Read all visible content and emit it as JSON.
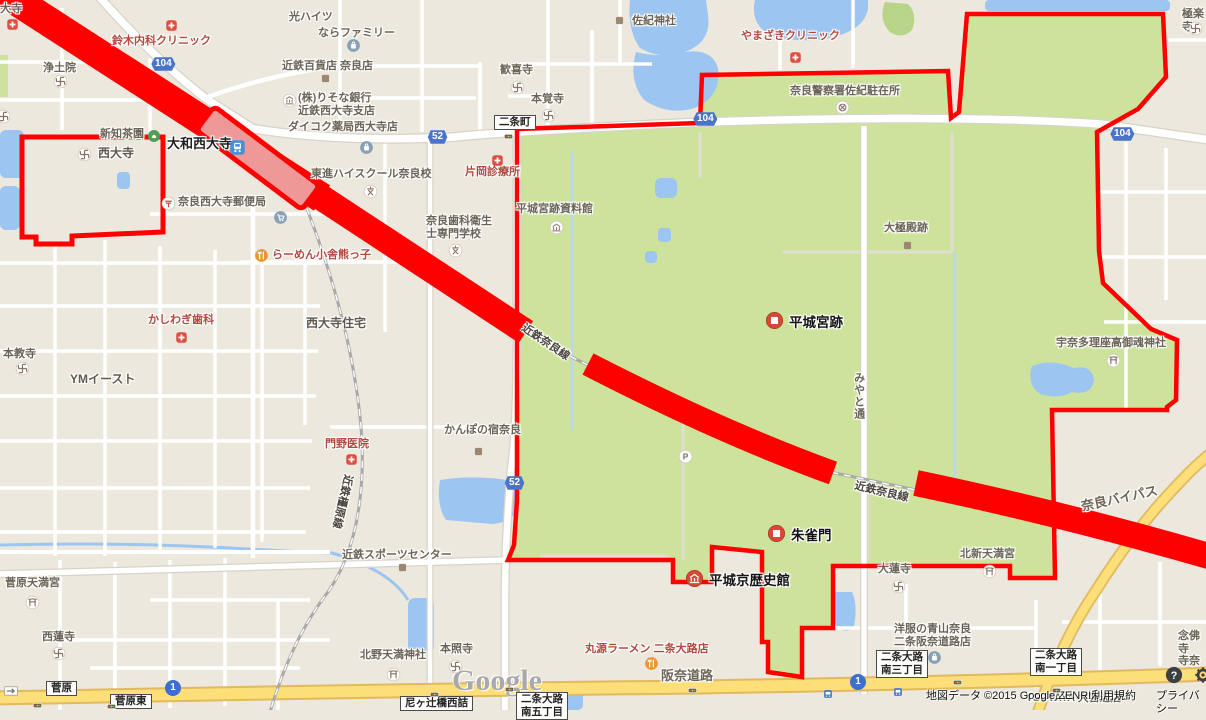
{
  "map": {
    "colors": {
      "background": "#ece8dd",
      "park_green": "#cde39c",
      "water": "#9dc5f2",
      "highlight_red": "#ff0000",
      "station_fill": "#ef9898",
      "yellow_road": "#fcdf79",
      "shield_blue": "#4b74c9"
    },
    "labels": [
      {
        "n": "poi-daiji-partial",
        "t": "大寺",
        "x": 0,
        "y": 3,
        "c": "poi"
      },
      {
        "n": "poi-jodoin",
        "t": "浄土院",
        "x": 43,
        "y": 62,
        "c": "poi"
      },
      {
        "n": "poi-hikari-heights",
        "t": "光ハイツ",
        "x": 289,
        "y": 11,
        "c": "poi"
      },
      {
        "n": "poi-nara-family",
        "t": "ならファミリー",
        "x": 318,
        "y": 27,
        "c": "poi"
      },
      {
        "n": "poi-kintetsu-dept",
        "t": "近鉄百貨店 奈良店",
        "x": 282,
        "y": 60,
        "c": "poi"
      },
      {
        "n": "poi-kankiji",
        "t": "歓喜寺",
        "x": 500,
        "y": 64,
        "c": "poi"
      },
      {
        "n": "poi-hongakuji",
        "t": "本覚寺",
        "x": 531,
        "y": 93,
        "c": "poi"
      },
      {
        "n": "poi-saki-jinja",
        "t": "佐紀神社",
        "x": 632,
        "y": 15,
        "c": "poi"
      },
      {
        "n": "poi-risona-bank",
        "t": "(株)りそな銀行\n近鉄西大寺支店",
        "x": 298,
        "y": 92,
        "c": "poi"
      },
      {
        "n": "poi-daikoku-pharmacy",
        "t": "ダイコク薬局西大寺店",
        "x": 288,
        "y": 121,
        "c": "poi"
      },
      {
        "n": "poi-nara-police-saki",
        "t": "奈良警察署佐紀駐在所",
        "x": 790,
        "y": 85,
        "c": "poi"
      },
      {
        "n": "poi-shinchi-chaen",
        "t": "新知茶園",
        "x": 100,
        "y": 128,
        "c": "poi"
      },
      {
        "n": "poi-saidaiji-temple",
        "t": "西大寺",
        "x": 98,
        "y": 147,
        "c": "poi2"
      },
      {
        "n": "poi-toshin-highschool",
        "t": "東進ハイスクール奈良校",
        "x": 311,
        "y": 168,
        "c": "poi"
      },
      {
        "n": "poi-saidaiji-post-office",
        "t": "奈良西大寺郵便局",
        "x": 178,
        "y": 196,
        "c": "poi"
      },
      {
        "n": "poi-heijo-shiryokan",
        "t": "平城宮跡資料館",
        "x": 516,
        "y": 203,
        "c": "poi"
      },
      {
        "n": "poi-nara-dental-school",
        "t": "奈良歯科衛生\n士専門学校",
        "x": 426,
        "y": 215,
        "c": "poi"
      },
      {
        "n": "poi-daigokuden-ruins",
        "t": "大極殿跡",
        "x": 884,
        "y": 222,
        "c": "poi"
      },
      {
        "n": "poi-gokurakuji",
        "t": "極楽寺",
        "x": 1182,
        "y": 8,
        "c": "poi"
      },
      {
        "n": "poi-saidaiji-jutaku",
        "t": "西大寺住宅",
        "x": 306,
        "y": 317,
        "c": "poi2"
      },
      {
        "n": "poi-honkyoji",
        "t": "本教寺",
        "x": 3,
        "y": 348,
        "c": "poi"
      },
      {
        "n": "poi-ym-east",
        "t": "YMイースト",
        "x": 70,
        "y": 373,
        "c": "poi2"
      },
      {
        "n": "poi-kanpo-no-yado",
        "t": "かんぽの宿奈良",
        "x": 444,
        "y": 424,
        "c": "poi"
      },
      {
        "n": "poi-unatari-jinja",
        "t": "宇奈多理座高御魂神社",
        "x": 1056,
        "y": 337,
        "c": "poi"
      },
      {
        "n": "poi-kintetsu-sports",
        "t": "近鉄スポーツセンター",
        "x": 342,
        "y": 549,
        "c": "poi"
      },
      {
        "n": "poi-dairenji",
        "t": "大蓮寺",
        "x": 878,
        "y": 563,
        "c": "poi"
      },
      {
        "n": "poi-kitashin-tenmangu",
        "t": "北新天満宮",
        "x": 960,
        "y": 548,
        "c": "poi"
      },
      {
        "n": "poi-sugahara-tenmangu",
        "t": "菅原天満宮",
        "x": 5,
        "y": 577,
        "c": "poi"
      },
      {
        "n": "poi-sairenji",
        "t": "西蓮寺",
        "x": 42,
        "y": 631,
        "c": "poi"
      },
      {
        "n": "poi-honshoji",
        "t": "本照寺",
        "x": 440,
        "y": 643,
        "c": "poi"
      },
      {
        "n": "poi-kitano-tenmanjinja",
        "t": "北野天満神社",
        "x": 360,
        "y": 649,
        "c": "poi"
      },
      {
        "n": "poi-aoyama",
        "t": "洋服の青山奈良\n二条阪奈道路店",
        "x": 894,
        "y": 623,
        "c": "poi"
      },
      {
        "n": "poi-tsutaya",
        "t": "TSUTAYA 大宮通店",
        "x": 1026,
        "y": 692,
        "c": "poi"
      },
      {
        "n": "poi-nenbutsuji",
        "t": "念佛寺\n寺奈",
        "x": 1178,
        "y": 630,
        "c": "poi"
      },
      {
        "n": "poi-suzuki-clinic",
        "t": "鈴木内科クリニック",
        "x": 112,
        "y": 35,
        "c": "red"
      },
      {
        "n": "poi-yamazaki-clinic",
        "t": "やまざきクリニック",
        "x": 741,
        "y": 30,
        "c": "red"
      },
      {
        "n": "poi-kataoka-clinic",
        "t": "片岡診療所",
        "x": 465,
        "y": 166,
        "c": "red"
      },
      {
        "n": "poi-ramen-kumakko",
        "t": "らーめん小舎熊っ子",
        "x": 272,
        "y": 249,
        "c": "red"
      },
      {
        "n": "poi-kashiwagi-dental",
        "t": "かしわぎ歯科",
        "x": 148,
        "y": 314,
        "c": "red"
      },
      {
        "n": "poi-kadono-clinic",
        "t": "門野医院",
        "x": 325,
        "y": 438,
        "c": "red"
      },
      {
        "n": "poi-marugen-ramen",
        "t": "丸源ラーメン 二条大路店",
        "x": 585,
        "y": 643,
        "c": "red"
      },
      {
        "n": "station-yamato-saidaiji",
        "t": "大和西大寺",
        "x": 167,
        "y": 137,
        "c": "big"
      },
      {
        "n": "road-hanna-doro",
        "t": "阪奈道路",
        "x": 661,
        "y": 669,
        "c": "road"
      },
      {
        "n": "road-nara-bypass",
        "t": "奈良バイパス",
        "x": 1080,
        "y": 500,
        "c": "road",
        "r": -12
      },
      {
        "n": "rail-kintetsu-nara-line-w",
        "t": "近鉄奈良線",
        "x": 526,
        "y": 322,
        "c": "rail",
        "r": 34
      },
      {
        "n": "rail-kintetsu-nara-line-e",
        "t": "近鉄奈良線",
        "x": 856,
        "y": 480,
        "c": "rail",
        "r": 13
      },
      {
        "n": "rail-kintetsu-kashihara-line",
        "t": "近鉄橿原線",
        "x": 354,
        "y": 476,
        "c": "rail",
        "r": 103
      },
      {
        "n": "road-miyato-dori",
        "t": "みやと通",
        "x": 852,
        "y": 372,
        "c": "vert"
      },
      {
        "n": "attribution-copyright",
        "t": "地図データ ©2015 Google,ZENRIN",
        "x": 926,
        "y": 690,
        "c": "attr"
      },
      {
        "n": "link-terms",
        "t": "利用規約",
        "x": 1092,
        "y": 690,
        "c": "attr",
        "i": true
      },
      {
        "n": "link-privacy",
        "t": "プライバシー",
        "x": 1156,
        "y": 690,
        "c": "attr",
        "i": true
      },
      {
        "n": "google-logo",
        "t": "Google",
        "x": 452,
        "y": 664,
        "c": "google",
        "i": true
      }
    ],
    "shields": [
      {
        "n": "shield-route-104-nw",
        "t": "104",
        "x": 149,
        "y": 57
      },
      {
        "n": "shield-route-104-mid",
        "t": "104",
        "x": 691,
        "y": 112
      },
      {
        "n": "shield-route-104-e",
        "t": "104",
        "x": 1108,
        "y": 127
      },
      {
        "n": "shield-route-52-w",
        "t": "52",
        "x": 426,
        "y": 130
      },
      {
        "n": "shield-route-52-s",
        "t": "52",
        "x": 503,
        "y": 476
      },
      {
        "n": "shield-route-1-w",
        "t": "1",
        "x": 165,
        "y": 680,
        "circle": true
      },
      {
        "n": "shield-route-1-e",
        "t": "1",
        "x": 850,
        "y": 674,
        "circle": true
      }
    ],
    "boxes": [
      {
        "n": "box-nijo-cho",
        "t": "二条町",
        "x": 494,
        "y": 115
      },
      {
        "n": "box-sugahara",
        "t": "菅原",
        "x": 46,
        "y": 681
      },
      {
        "n": "box-sugahara-higashi",
        "t": "菅原東",
        "x": 110,
        "y": 694
      },
      {
        "n": "box-amagatsuji-bashi",
        "t": "尼ヶ辻橋西詰",
        "x": 400,
        "y": 696
      },
      {
        "n": "box-nijooji-minami-5",
        "t": "二条大路\n南五丁目",
        "x": 516,
        "y": 692
      },
      {
        "n": "box-nijooji-minami-3",
        "t": "二条大路\n南三丁目",
        "x": 876,
        "y": 650
      },
      {
        "n": "box-nijooji-minami-1",
        "t": "二条大路\n南一丁目",
        "x": 1030,
        "y": 648
      }
    ],
    "markers": [
      {
        "n": "marker-heijo-palace-site",
        "t": "平城宮跡",
        "k": "marker",
        "cx": 774,
        "cy": 320,
        "tx": 789,
        "ty": 311
      },
      {
        "n": "marker-suzaku-gate",
        "t": "朱雀門",
        "k": "marker",
        "cx": 776,
        "cy": 533,
        "tx": 791,
        "ty": 524
      },
      {
        "n": "marker-heijokyo-history-museum",
        "t": "平城京歴史館",
        "k": "markermuseum",
        "cx": 694,
        "cy": 578,
        "tx": 709,
        "ty": 569
      }
    ],
    "icons": [
      {
        "n": "clinic-icon-daiji",
        "k": "cross",
        "x": 12,
        "y": 24
      },
      {
        "n": "manji-icon-edge",
        "k": "manji",
        "x": 3,
        "y": 116
      },
      {
        "n": "manji-icon-jodoin",
        "k": "manji",
        "x": 60,
        "y": 81
      },
      {
        "n": "clinic-icon-suzuki",
        "k": "cross",
        "x": 171,
        "y": 25
      },
      {
        "n": "bag-icon-narafamily",
        "k": "bag",
        "x": 353,
        "y": 45
      },
      {
        "n": "square-icon-kintetsu-dept",
        "k": "sq",
        "x": 325,
        "y": 78
      },
      {
        "n": "manji-icon-kankiji",
        "k": "manji",
        "x": 517,
        "y": 87
      },
      {
        "n": "manji-icon-hongakuji",
        "k": "manji",
        "x": 548,
        "y": 115
      },
      {
        "n": "square-icon-saki-jinja",
        "k": "sq",
        "x": 619,
        "y": 20
      },
      {
        "n": "clinic-icon-yamazaki",
        "k": "cross",
        "x": 795,
        "y": 57
      },
      {
        "n": "bank-icon-risona",
        "k": "bank",
        "x": 289,
        "y": 100
      },
      {
        "n": "bag-icon-daikoku",
        "k": "bag",
        "x": 366,
        "y": 147
      },
      {
        "n": "train-station-icon",
        "k": "train",
        "x": 237,
        "y": 147
      },
      {
        "n": "tea-icon-shinchi",
        "k": "tea",
        "x": 154,
        "y": 136
      },
      {
        "n": "manji-icon-saidaiji",
        "k": "manji",
        "x": 84,
        "y": 154
      },
      {
        "n": "police-icon-saki",
        "k": "police",
        "x": 842,
        "y": 107
      },
      {
        "n": "post-icon-saidaiji",
        "k": "post",
        "x": 168,
        "y": 203
      },
      {
        "n": "school-icon-toshin",
        "k": "school",
        "x": 370,
        "y": 191
      },
      {
        "n": "clinic-icon-kataoka",
        "k": "cross",
        "x": 497,
        "y": 160
      },
      {
        "n": "museum-icon-shiryokan",
        "k": "museum",
        "x": 556,
        "y": 227
      },
      {
        "n": "school-icon-dental",
        "k": "school",
        "x": 455,
        "y": 250
      },
      {
        "n": "fork-icon-kumakko",
        "k": "fork",
        "x": 261,
        "y": 255
      },
      {
        "n": "square-icon-daigokuden",
        "k": "sq",
        "x": 907,
        "y": 245
      },
      {
        "n": "manji-icon-gokurakuji",
        "k": "manji",
        "x": 1195,
        "y": 28
      },
      {
        "n": "clinic-icon-kashiwagi",
        "k": "cross",
        "x": 181,
        "y": 337
      },
      {
        "n": "manji-icon-honkyoji",
        "k": "manji",
        "x": 22,
        "y": 368
      },
      {
        "n": "clinic-icon-kadono",
        "k": "cross",
        "x": 351,
        "y": 459
      },
      {
        "n": "torii-icon-unatari",
        "k": "torii",
        "x": 1113,
        "y": 360
      },
      {
        "n": "square-icon-kanpo",
        "k": "sq",
        "x": 478,
        "y": 451
      },
      {
        "n": "parking-icon",
        "k": "parking",
        "x": 685,
        "y": 456
      },
      {
        "n": "cart-icon-station",
        "k": "cart",
        "x": 280,
        "y": 217
      },
      {
        "n": "manji-icon-dairenji",
        "k": "manji",
        "x": 898,
        "y": 586
      },
      {
        "n": "torii-icon-kitashin",
        "k": "torii",
        "x": 989,
        "y": 571
      },
      {
        "n": "bag-icon-aoyama",
        "k": "bag",
        "x": 934,
        "y": 657
      },
      {
        "n": "torii-icon-sugahara",
        "k": "torii",
        "x": 32,
        "y": 602
      },
      {
        "n": "manji-icon-sairenji",
        "k": "manji",
        "x": 58,
        "y": 653
      },
      {
        "n": "manji-icon-honshoji",
        "k": "manji",
        "x": 455,
        "y": 666
      },
      {
        "n": "torii-icon-kitano",
        "k": "torii",
        "x": 393,
        "y": 674
      },
      {
        "n": "fork-icon-marugen",
        "k": "fork",
        "x": 651,
        "y": 663
      },
      {
        "n": "square-icon-sports",
        "k": "sq",
        "x": 402,
        "y": 567
      },
      {
        "n": "traffic-light-nijo",
        "k": "traffic",
        "x": 508,
        "y": 136
      },
      {
        "n": "traffic-light-1",
        "k": "traffic",
        "x": 37,
        "y": 705
      },
      {
        "n": "traffic-light-2",
        "k": "traffic",
        "x": 111,
        "y": 706
      },
      {
        "n": "traffic-light-3",
        "k": "traffic",
        "x": 434,
        "y": 694
      },
      {
        "n": "traffic-light-4",
        "k": "traffic",
        "x": 509,
        "y": 689
      },
      {
        "n": "traffic-light-5",
        "k": "traffic",
        "x": 692,
        "y": 690
      },
      {
        "n": "traffic-light-6",
        "k": "traffic",
        "x": 957,
        "y": 682
      },
      {
        "n": "traffic-light-7",
        "k": "traffic",
        "x": 1056,
        "y": 690
      },
      {
        "n": "bus-icon-1",
        "k": "bus",
        "x": 828,
        "y": 694
      },
      {
        "n": "bus-icon-2",
        "k": "bus",
        "x": 898,
        "y": 692
      },
      {
        "n": "arrow-icon-sugahara",
        "k": "arrow",
        "x": 11,
        "y": 691
      },
      {
        "n": "help-icon",
        "k": "help",
        "x": 1174,
        "y": 675,
        "i": true
      },
      {
        "n": "gear-icon",
        "k": "gear",
        "x": 1203,
        "y": 675,
        "i": true
      }
    ]
  }
}
